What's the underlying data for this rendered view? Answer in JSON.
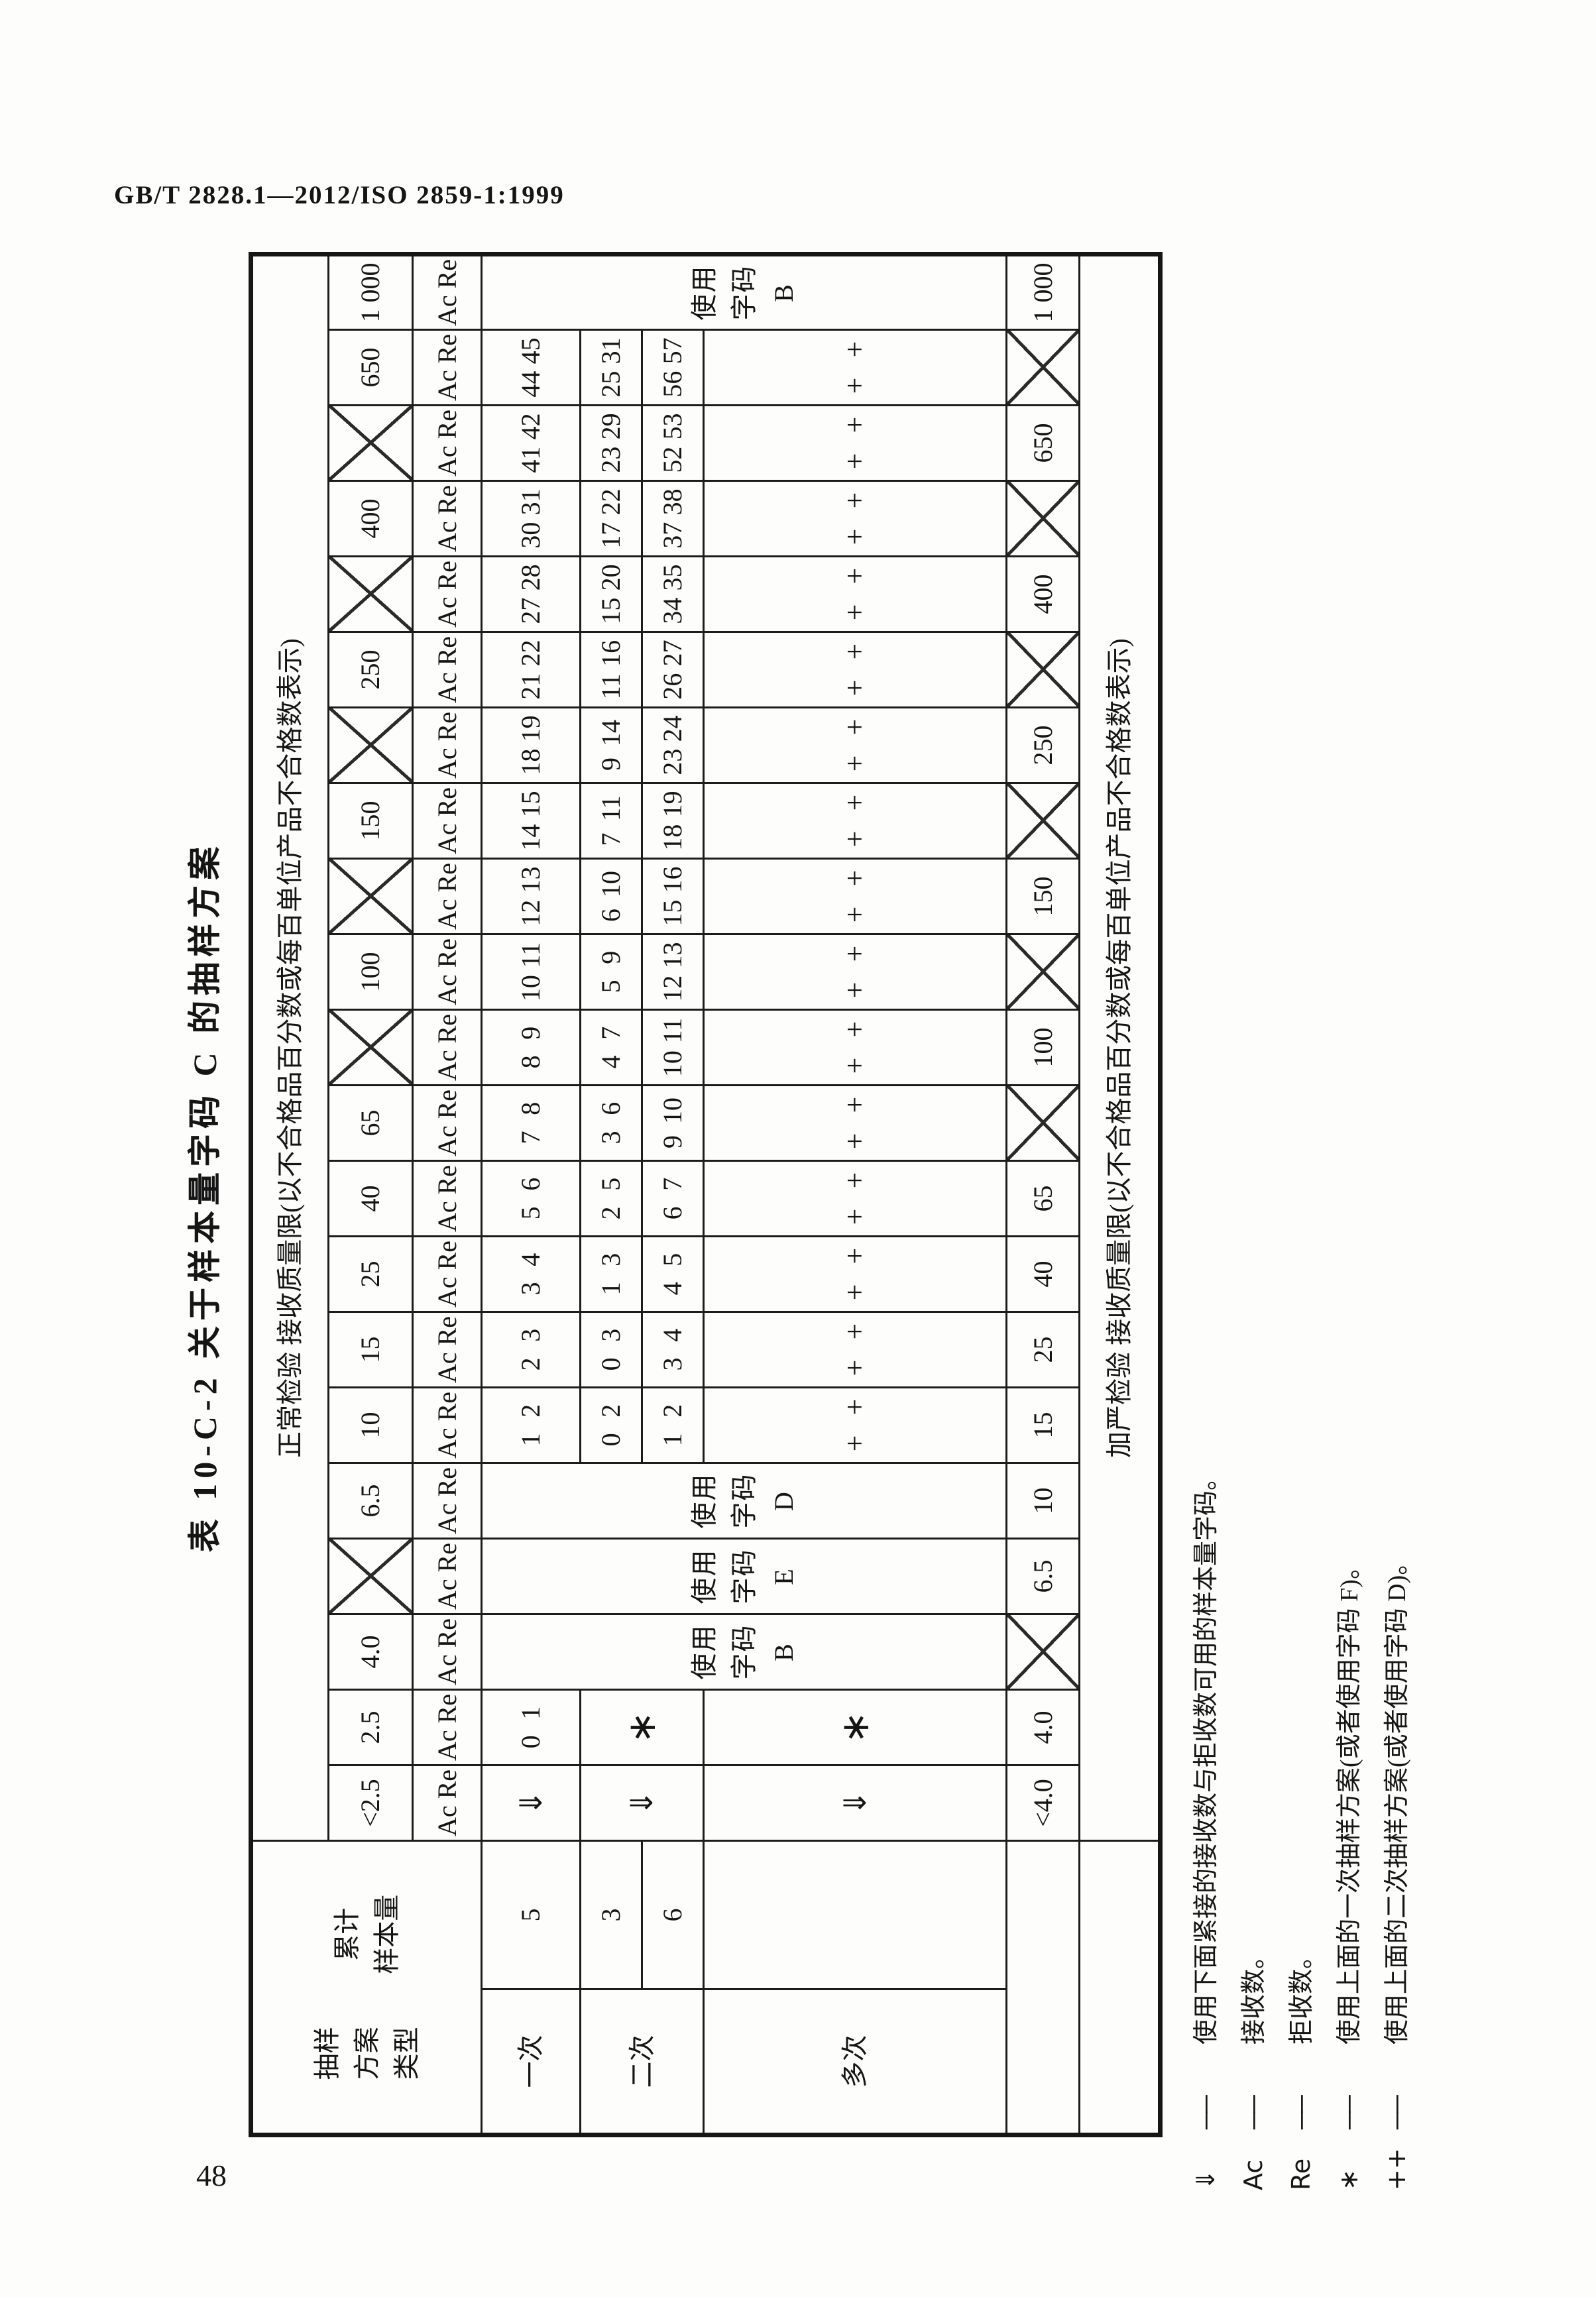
{
  "page": {
    "header": "GB/T 2828.1—2012/ISO 2859-1:1999",
    "page_number": "48"
  },
  "table": {
    "title": "表 10-C-2  关于样本量字码 C 的抽样方案",
    "normal_header": "正常检验  接收质量限(以不合格品百分数或每百单位产品不合格数表示)",
    "tightened_header": "加严检验  接收质量限(以不合格品百分数或每百单位产品不合格数表示)",
    "ac_re_label": "Ac Re",
    "corner": {
      "plan_type_lines": [
        "抽样",
        "方案",
        "类型"
      ],
      "cum_size_lines": [
        "累计",
        "样本量"
      ]
    },
    "plan_rows": {
      "single_label": "一次",
      "single_cum": "5",
      "double_label": "二次",
      "double_cum_1": "3",
      "double_cum_2": "6",
      "multiple_label": "多次"
    },
    "use_code_prefix_lines": [
      "使用",
      "字码"
    ],
    "columns": [
      {
        "normal": "<2.5",
        "tightened": "<4.0",
        "single": "⇓",
        "double1": "⇓",
        "multiple": "⇓"
      },
      {
        "normal": "2.5",
        "tightened": "4.0",
        "single": "0 1",
        "double1": "∗",
        "multiple": "∗"
      },
      {
        "normal": "4.0",
        "tightened": "X",
        "use_code": "B"
      },
      {
        "normal": "X",
        "tightened": "6.5",
        "use_code": "E"
      },
      {
        "normal": "6.5",
        "tightened": "10",
        "use_code": "D"
      },
      {
        "normal": "10",
        "tightened": "15",
        "single": "1 2",
        "double1": "0 2",
        "double2": "1 2",
        "multiple": "++"
      },
      {
        "normal": "15",
        "tightened": "25",
        "single": "2 3",
        "double1": "0 3",
        "double2": "3 4",
        "multiple": "++"
      },
      {
        "normal": "25",
        "tightened": "40",
        "single": "3 4",
        "double1": "1 3",
        "double2": "4 5",
        "multiple": "++"
      },
      {
        "normal": "40",
        "tightened": "65",
        "single": "5 6",
        "double1": "2 5",
        "double2": "6 7",
        "multiple": "++"
      },
      {
        "normal": "65",
        "tightened": "X",
        "single": "7 8",
        "double1": "3 6",
        "double2": "9 10",
        "multiple": "++"
      },
      {
        "normal": "X",
        "tightened": "100",
        "single": "8 9",
        "double1": "4 7",
        "double2": "10 11",
        "multiple": "++"
      },
      {
        "normal": "100",
        "tightened": "X",
        "single": "10 11",
        "double1": "5 9",
        "double2": "12 13",
        "multiple": "++"
      },
      {
        "normal": "X",
        "tightened": "150",
        "single": "12 13",
        "double1": "6 10",
        "double2": "15 16",
        "multiple": "++"
      },
      {
        "normal": "150",
        "tightened": "X",
        "single": "14 15",
        "double1": "7 11",
        "double2": "18 19",
        "multiple": "++"
      },
      {
        "normal": "X",
        "tightened": "250",
        "single": "18 19",
        "double1": "9 14",
        "double2": "23 24",
        "multiple": "++"
      },
      {
        "normal": "250",
        "tightened": "X",
        "single": "21 22",
        "double1": "11 16",
        "double2": "26 27",
        "multiple": "++"
      },
      {
        "normal": "X",
        "tightened": "400",
        "single": "27 28",
        "double1": "15 20",
        "double2": "34 35",
        "multiple": "++"
      },
      {
        "normal": "400",
        "tightened": "X",
        "single": "30 31",
        "double1": "17 22",
        "double2": "37 38",
        "multiple": "++"
      },
      {
        "normal": "X",
        "tightened": "650",
        "single": "41 42",
        "double1": "23 29",
        "double2": "52 53",
        "multiple": "++"
      },
      {
        "normal": "650",
        "tightened": "X",
        "single": "44 45",
        "double1": "25 31",
        "double2": "56 57",
        "multiple": "++"
      },
      {
        "normal": "1 000",
        "tightened": "1 000",
        "use_code": "B"
      }
    ]
  },
  "notes": {
    "dash": "──",
    "items": [
      {
        "symbol": "⇓",
        "text": "使用下面紧接的接收数与拒收数可用的样本量字码。"
      },
      {
        "symbol": "Ac",
        "text": "接收数。"
      },
      {
        "symbol": "Re",
        "text": "拒收数。"
      },
      {
        "symbol": "∗",
        "text": "使用上面的一次抽样方案(或者使用字码 F)。"
      },
      {
        "symbol": "++",
        "text": "使用上面的二次抽样方案(或者使用字码 D)。"
      }
    ]
  }
}
